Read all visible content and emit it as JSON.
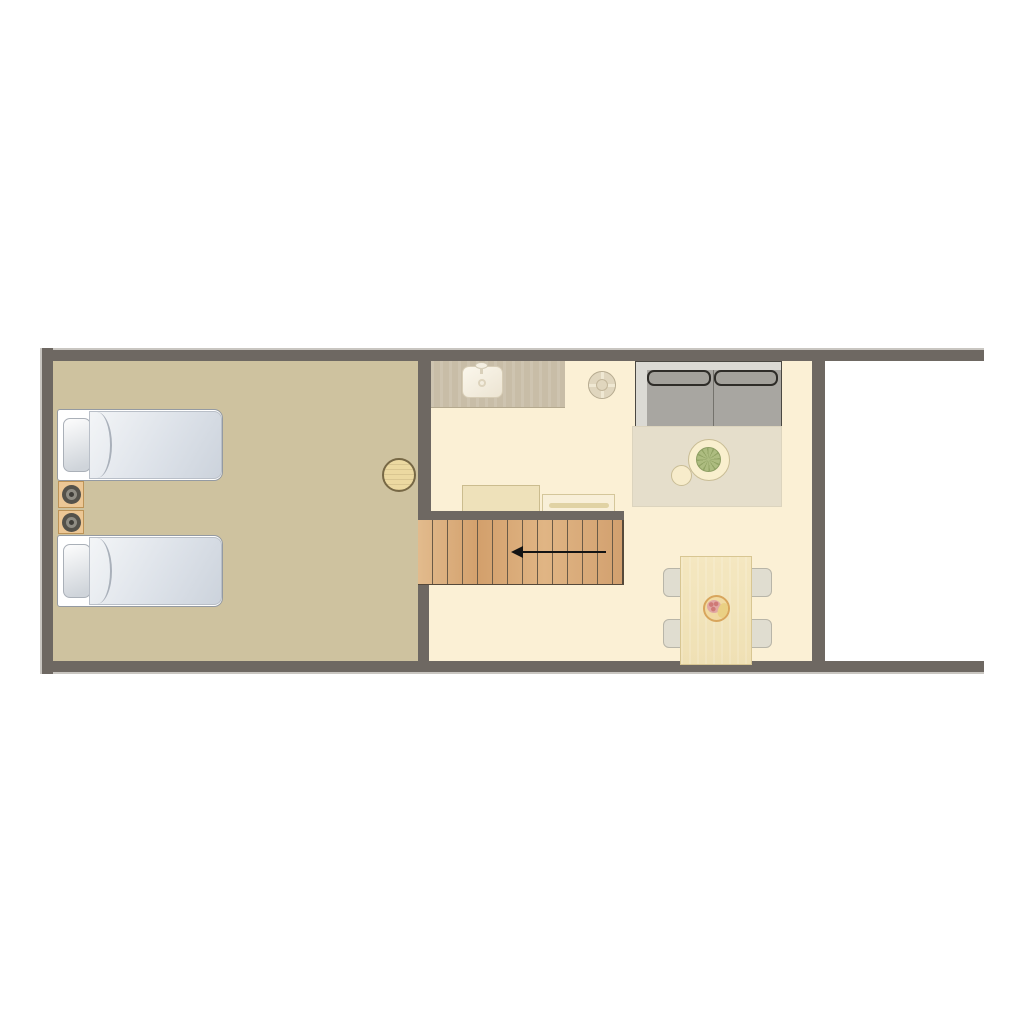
{
  "canvas": {
    "width": 1024,
    "height": 1024,
    "background": "#ffffff"
  },
  "diagram_type": "apartment-floor-plan",
  "palette": {
    "wall": "#6e6862",
    "wall_highlight": "#c9c6c1",
    "bedroom_floor": "#cec29f",
    "living_floor": "#fbf0d5",
    "kitchen_counter": "#c8bda7",
    "stair_wood": "#d9ac79",
    "stair_tread_line": "#6b5b47",
    "rug": "#e5decb",
    "sofa_frame": "#dbdad4",
    "sofa_cushion": "#a8a6a1",
    "sofa_cushion_outline": "#2e2c28",
    "bed_duvet": "#dde2e9",
    "bed_pillow": "#e3e7ec",
    "nightstand_wood": "#ecc795",
    "furniture_wood_light": "#f3e6bd",
    "plant_green": "#a0b070",
    "fruit_bowl": "#f1d99f",
    "arrow": "#141414"
  },
  "rooms": [
    {
      "id": "bedroom",
      "label": "bedroom",
      "position": "left",
      "floor_color": "#cec29f"
    },
    {
      "id": "living-kitchen-dining",
      "label": "living / kitchen / dining",
      "position": "right",
      "floor_color": "#fbf0d5"
    }
  ],
  "furniture": {
    "bed1": {
      "label": "single bed with pillow and duvet",
      "count_pillows": 1
    },
    "bed2": {
      "label": "single bed with pillow and duvet",
      "count_pillows": 1
    },
    "nightstand1": {
      "label": "nightstand with lamp"
    },
    "nightstand2": {
      "label": "nightstand with lamp"
    },
    "stool": {
      "label": "round stool"
    },
    "counter": {
      "label": "kitchen counter"
    },
    "sink": {
      "label": "kitchen sink with faucet"
    },
    "ceiling_light": {
      "label": "ceiling light fixture"
    },
    "sofa": {
      "label": "two-seat sofa with back cushions",
      "seats": 2
    },
    "rug": {
      "label": "area rug"
    },
    "coffee_table": {
      "label": "round side table"
    },
    "plant": {
      "label": "potted plant"
    },
    "pouf": {
      "label": "round pouf"
    },
    "cabinet_a": {
      "label": "low cabinet"
    },
    "cabinet_b": {
      "label": "media console with handle"
    },
    "dining_table": {
      "label": "dining table"
    },
    "chairs": {
      "label": "dining chair",
      "count": 4
    },
    "fruit_bowl": {
      "label": "fruit bowl"
    }
  },
  "stairs": {
    "label": "staircase",
    "tread_count": 13,
    "arrow_direction": "left",
    "arrow_meaning": "descend toward bedroom side"
  },
  "walls": {
    "outer": [
      "top",
      "bottom",
      "left"
    ],
    "right_side": "open beyond interior partition",
    "interior": [
      "bedroom partition",
      "stair head wall",
      "stair foot stub",
      "right partition"
    ]
  }
}
